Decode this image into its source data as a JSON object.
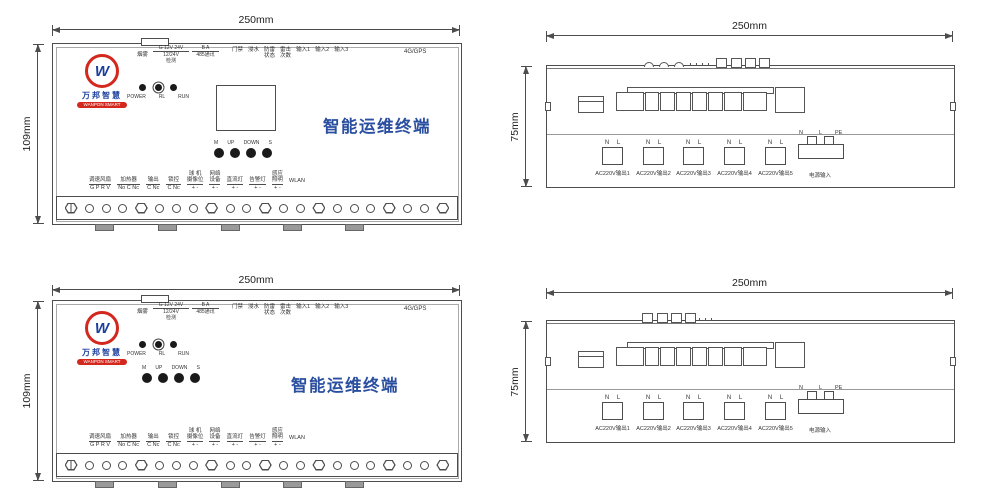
{
  "front_panel": {
    "dim_width": "250mm",
    "dim_height": "109mm",
    "logo": {
      "cn": "万邦智慧",
      "en": "WANPON SMART",
      "monogram": "W"
    },
    "title": "智能运维终端",
    "smoke_label": "烟雾",
    "power_detect": {
      "line1": "G 12V 24V",
      "line2": "12/24V",
      "line3": "检测"
    },
    "comm_485": {
      "line1": "B A",
      "line2": "485通讯"
    },
    "status_labels": [
      {
        "l1": "门禁",
        "l2": ""
      },
      {
        "l1": "浸水",
        "l2": ""
      },
      {
        "l1": "防雷",
        "l2": "状态"
      },
      {
        "l1": "雷击",
        "l2": "次数"
      },
      {
        "l1": "输入1",
        "l2": ""
      },
      {
        "l1": "输入2",
        "l2": ""
      },
      {
        "l1": "输入3",
        "l2": ""
      }
    ],
    "gps_label": "4G/GPS",
    "led_labels": [
      "POWER",
      "RL",
      "RUN"
    ],
    "key_labels": [
      "M",
      "UP",
      "DOWN",
      "S"
    ],
    "io_groups": [
      {
        "name": [
          "调速风扇"
        ],
        "terms": "G P R V"
      },
      {
        "name": [
          "加热器"
        ],
        "terms": "No C Nc"
      },
      {
        "name": [
          "输出"
        ],
        "terms": "C Nc"
      },
      {
        "name": [
          "锁控"
        ],
        "terms": "C Nc"
      },
      {
        "name": [
          "球 机",
          "摄像位"
        ],
        "terms": "+ -"
      },
      {
        "name": [
          "网络",
          "设备"
        ],
        "terms": "+ -"
      },
      {
        "name": [
          "直流灯"
        ],
        "terms": "+ -"
      },
      {
        "name": [
          "告警灯"
        ],
        "terms": "+ -"
      },
      {
        "name": [
          "感应",
          "照明"
        ],
        "terms": "+ -"
      },
      {
        "name": [
          "WLAN"
        ],
        "terms": ""
      }
    ],
    "gland_pattern": [
      "hex-slot",
      "circle",
      "circle",
      "circle",
      "hex",
      "circle",
      "circle",
      "circle",
      "hex",
      "circle",
      "circle",
      "hex",
      "circle",
      "circle",
      "hex",
      "circle",
      "circle",
      "circle",
      "hex",
      "circle",
      "circle",
      "hex"
    ]
  },
  "rear_panel": {
    "dim_width": "250mm",
    "dim_height": "75mm",
    "outputs": [
      {
        "pins": "N L",
        "label": "AC220V输出1"
      },
      {
        "pins": "N L",
        "label": "AC220V输出2"
      },
      {
        "pins": "N L",
        "label": "AC220V输出3"
      },
      {
        "pins": "N L",
        "label": "AC220V输出4"
      },
      {
        "pins": "N L",
        "label": "AC220V输出5"
      }
    ],
    "power_input": {
      "pins": [
        "N",
        "L",
        "PE"
      ],
      "label": "电源输入"
    }
  },
  "colors": {
    "line": "#4d4d4d",
    "title_blue": "#2b4fa0",
    "logo_red": "#d3281e",
    "logo_blue": "#1c3f9e"
  }
}
